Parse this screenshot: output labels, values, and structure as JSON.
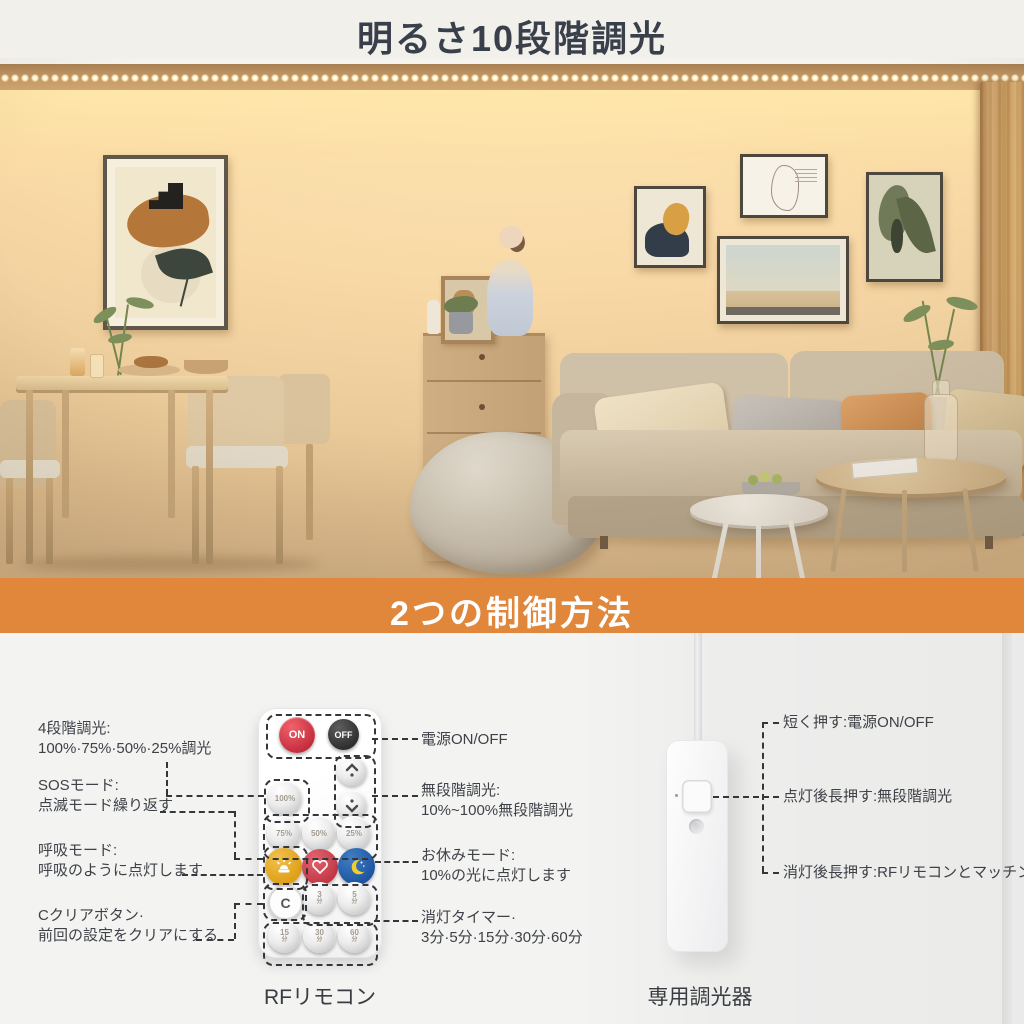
{
  "banner_top": {
    "title": "明るさ10段階調光"
  },
  "banner_mid": {
    "title": "2つの制御方法"
  },
  "colors": {
    "accent_orange": "#E0873C",
    "top_banner_bg": "#F1F0EA",
    "title_text": "#39404C",
    "banner_text": "#FFFFFF",
    "on_button": "#C62F3E",
    "off_button": "#2F2F2F",
    "sos_button": "#DF9F16",
    "breath_button": "#C33746",
    "sleep_button": "#1F55A0"
  },
  "remote": {
    "caption": "RFリモコン",
    "on_label": "ON",
    "off_label": "OFF",
    "clear_label": "C",
    "unit_min": "分",
    "percents": [
      "100%",
      "75%",
      "50%",
      "25%"
    ],
    "timers": [
      "3",
      "5",
      "15",
      "30",
      "60"
    ],
    "icons": [
      "chevron-up",
      "chevron-down",
      "siren",
      "heart",
      "moon"
    ],
    "labels_left": [
      {
        "title": "4段階調光:",
        "desc": "100%·75%·50%·25%調光"
      },
      {
        "title": "SOSモード:",
        "desc": "点滅モード繰り返す"
      },
      {
        "title": "呼吸モード:",
        "desc": "呼吸のように点灯します"
      },
      {
        "title": "Cクリアボタン·",
        "desc": "前回の設定をクリアにする"
      }
    ],
    "labels_right": [
      {
        "title": "電源ON/OFF",
        "desc": ""
      },
      {
        "title": "無段階調光:",
        "desc": "10%~100%無段階調光"
      },
      {
        "title": "お休みモード:",
        "desc": "10%の光に点灯します"
      },
      {
        "title": "消灯タイマー·",
        "desc": "3分·5分·15分·30分·60分"
      }
    ]
  },
  "dimmer": {
    "caption": "専用調光器",
    "labels": [
      "短く押す:電源ON/OFF",
      "点灯後長押す:無段階調光",
      "消灯後長押す:RFリモコンとマッチング"
    ]
  }
}
